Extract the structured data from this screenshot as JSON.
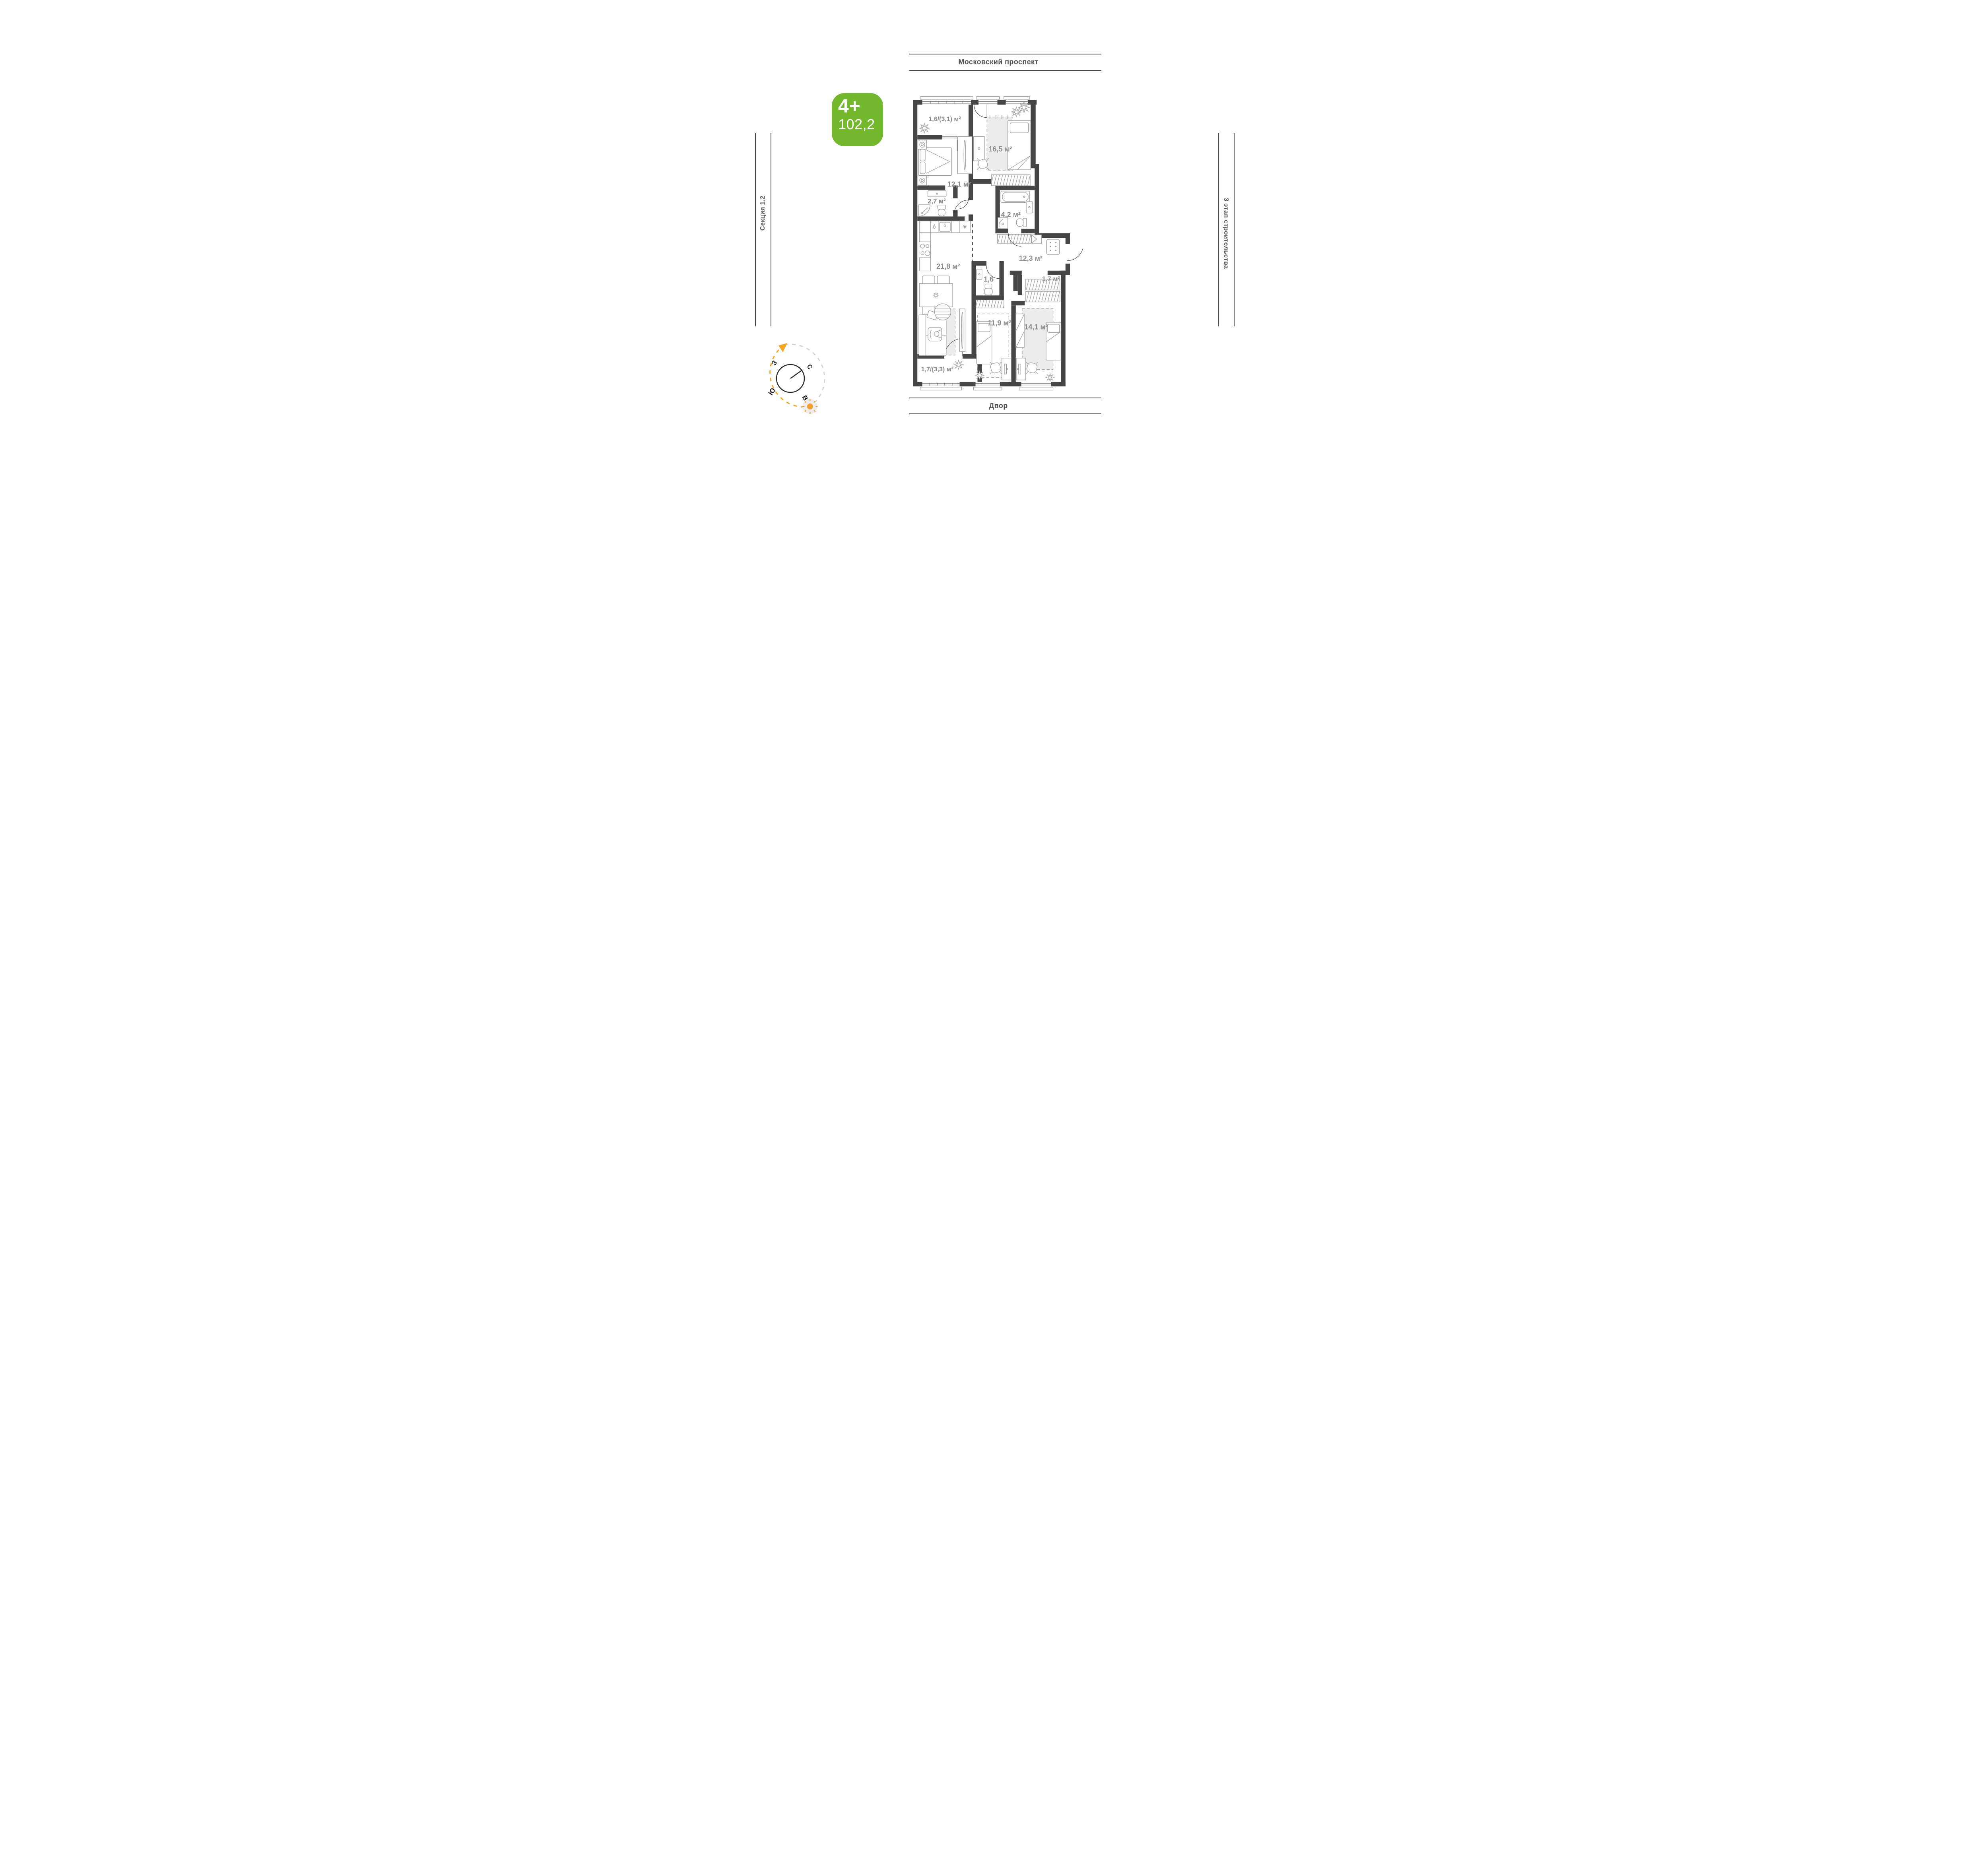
{
  "surroundings": {
    "top": "Московский проспект",
    "bottom": "Двор",
    "left": "Секция 1.2",
    "right": "3 этап строительства"
  },
  "badge": {
    "rooms_label": "4+",
    "area_value": "102,2",
    "color": "#74b82d"
  },
  "compass": {
    "west": "З",
    "north": "С",
    "south": "Ю",
    "east": "В",
    "sun_color": "#f0a030",
    "arc_orange": "#f5a623",
    "arc_gray": "#d6d6d6"
  },
  "rooms": [
    {
      "id": "balcony-top",
      "area": "1,6/(3,1) м²"
    },
    {
      "id": "bedroom-16-5",
      "area": "16,5 м²"
    },
    {
      "id": "bedroom-12-1",
      "area": "12,1 м²"
    },
    {
      "id": "bathroom-2-7",
      "area": "2,7 м²"
    },
    {
      "id": "bathroom-4-2",
      "area": "4,2 м²"
    },
    {
      "id": "kitchen-living-21-8",
      "area": "21,8 м²"
    },
    {
      "id": "hallway-12-3",
      "area": "12,3 м²"
    },
    {
      "id": "wc-1-6",
      "area": "1,6"
    },
    {
      "id": "closet-1-7",
      "area": "1,7 м²"
    },
    {
      "id": "bedroom-11-9",
      "area": "11,9 м²"
    },
    {
      "id": "bedroom-14-1",
      "area": "14,1 м²"
    },
    {
      "id": "balcony-bottom",
      "area": "1,7/(3,3) м²"
    }
  ]
}
